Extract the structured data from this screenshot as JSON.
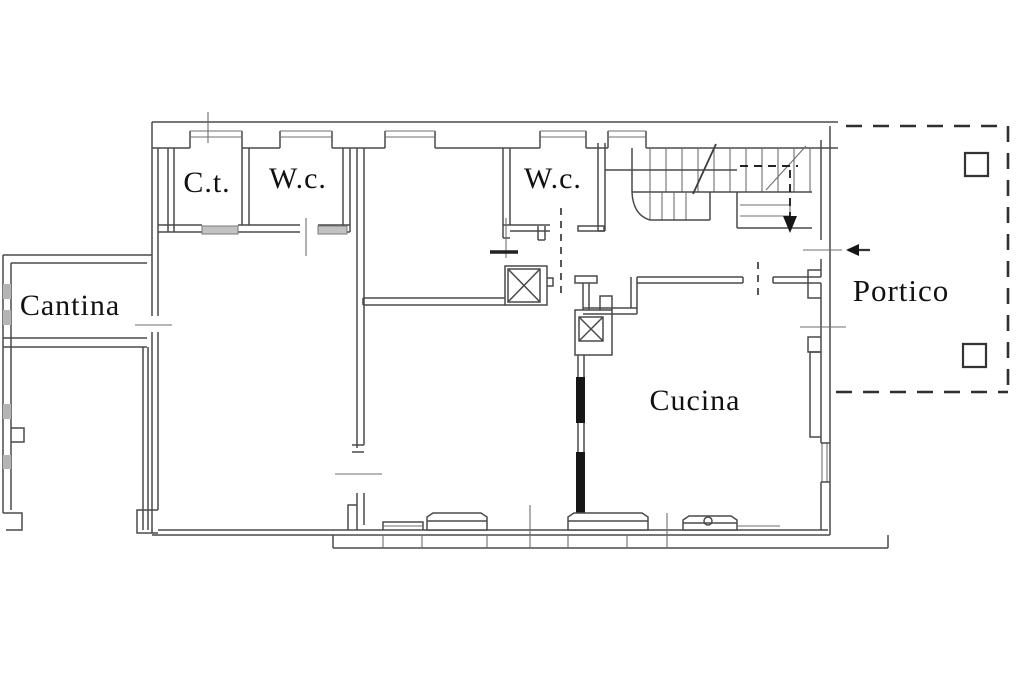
{
  "title": "Planimetria piano - floor plan",
  "rooms": [
    {
      "id": "ct",
      "label": "C.t."
    },
    {
      "id": "wc1",
      "label": "W.c."
    },
    {
      "id": "wc2",
      "label": "W.c."
    },
    {
      "id": "cantina",
      "label": "Cantina"
    },
    {
      "id": "cucina",
      "label": "Cucina"
    },
    {
      "id": "portico",
      "label": "Portico"
    }
  ],
  "symbols": [
    {
      "id": "stair-down-arrow",
      "meaning": "dashed arrow indicating stair direction"
    },
    {
      "id": "entrance-arrow",
      "meaning": "arrow pointing into building from portico"
    },
    {
      "id": "flue-box-1",
      "meaning": "crossed square duct/flue in middle room"
    },
    {
      "id": "flue-box-2",
      "meaning": "crossed square duct/flue in kitchen"
    },
    {
      "id": "portico-pillars",
      "meaning": "two square pillars on dashed portico boundary"
    }
  ],
  "colors": {
    "background": "#ffffff",
    "line": "#4a4a4a",
    "line_dark": "#1a1a1a",
    "text": "#111111"
  }
}
